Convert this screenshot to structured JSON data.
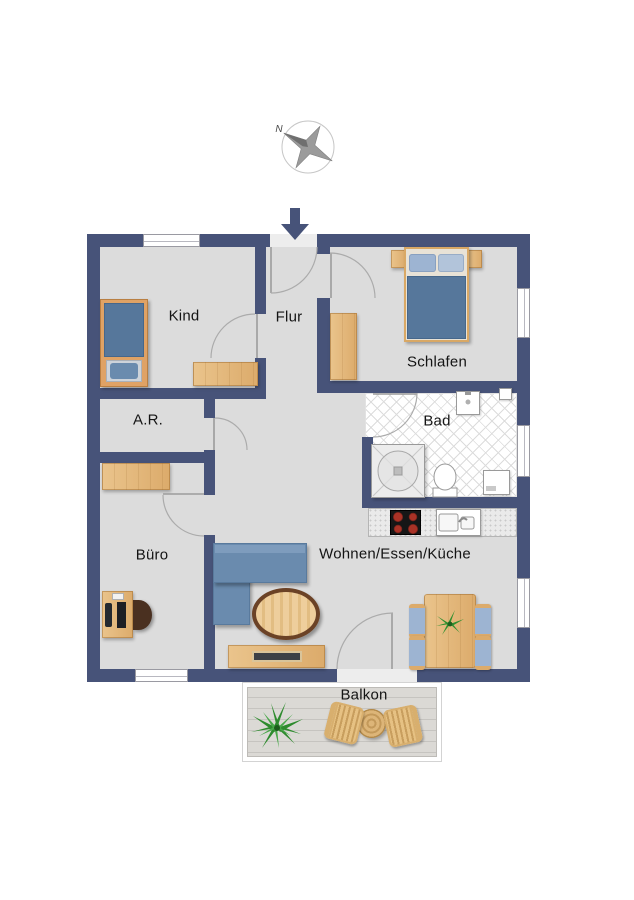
{
  "compass": {
    "north_label": "N"
  },
  "rooms": {
    "kind": {
      "label": "Kind"
    },
    "flur": {
      "label": "Flur"
    },
    "schlafen": {
      "label": "Schlafen"
    },
    "abstellraum": {
      "label": "A.R."
    },
    "bad": {
      "label": "Bad"
    },
    "buero": {
      "label": "Büro"
    },
    "wohnen": {
      "label": "Wohnen/Essen/Küche"
    },
    "balkon": {
      "label": "Balkon"
    }
  },
  "furniture_icons": {
    "kind": [
      "single-bed",
      "desk"
    ],
    "schlafen": [
      "double-bed",
      "nightstand-left",
      "nightstand-right",
      "wardrobe"
    ],
    "bad": [
      "shower",
      "toilet",
      "washbasin",
      "washing-machine",
      "shaft"
    ],
    "kueche": [
      "kitchen-counter",
      "cooktop",
      "kitchen-sink"
    ],
    "wohnen": [
      "corner-sofa",
      "coffee-table",
      "tv-sideboard",
      "dining-table",
      "dining-chairs",
      "table-plant"
    ],
    "buero": [
      "sideboard",
      "desk-with-pc",
      "office-chair"
    ],
    "balkon": [
      "potted-plant",
      "bistro-table",
      "wicker-chair-left",
      "wicker-chair-right"
    ],
    "misc": [
      "compass-rose",
      "entrance-arrow",
      "door-swing-arcs",
      "windows"
    ]
  },
  "colors": {
    "wall": "#475379",
    "floor": "#dcdcdc",
    "tile_floor": "#ffffff",
    "wood": "#eac48c",
    "wood_dark": "#dcab6b",
    "sofa_blue": "#6a8bae",
    "bed_blue": "#56779b",
    "pillow_blue": "#9db4d2",
    "table_rim_brown": "#6b4226",
    "deck_gray": "#d8d6d2",
    "arc_gray": "#ababab",
    "burner_red": "#a93226",
    "plant_green": "#2f8f2f"
  }
}
